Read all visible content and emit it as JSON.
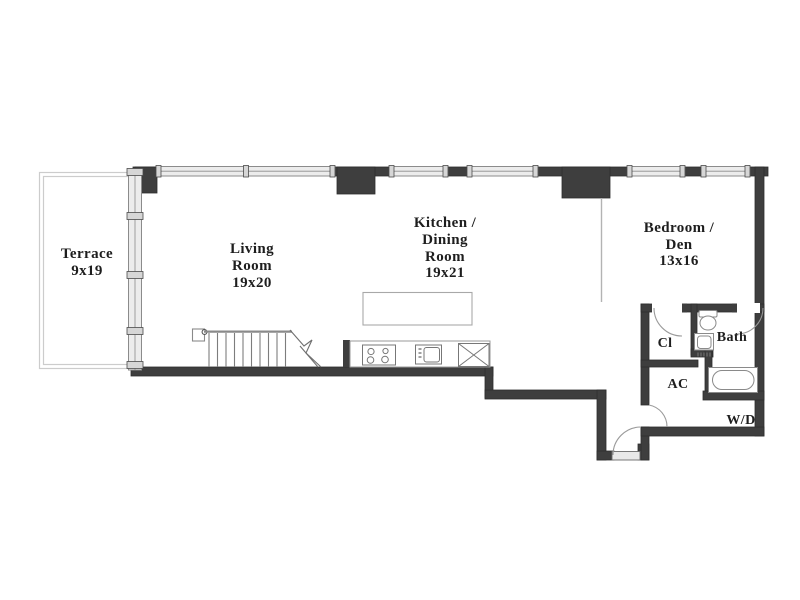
{
  "colors": {
    "wall": "#3e3e3e",
    "window_fill": "#ececec",
    "window_stroke": "#8b8b8b",
    "window_cap": "#d6d6d6",
    "fixture_stroke": "#8a8a8a",
    "terrace_outline": "#cccccc",
    "text": "#1e1e1e",
    "background": "#ffffff"
  },
  "rooms": {
    "terrace": {
      "name": "Terrace",
      "dims": "9x19"
    },
    "living_room": {
      "line1": "Living",
      "line2": "Room",
      "dims": "19x20"
    },
    "kitchen_dining": {
      "line1": "Kitchen /",
      "line2": "Dining",
      "line3": "Room",
      "dims": "19x21"
    },
    "bedroom_den": {
      "line1": "Bedroom /",
      "line2": "Den",
      "dims": "13x16"
    },
    "closet": {
      "name": "Cl"
    },
    "bath": {
      "name": "Bath"
    },
    "ac": {
      "name": "AC"
    },
    "washer_dryer": {
      "name": "W/D"
    }
  },
  "icons": {
    "staircase": "staircase-with-break-line",
    "kitchen_island": "kitchen-island",
    "range": "range-4-burner-icon",
    "kitchen_sink": "kitchen-sink-icon",
    "x_appliance": "appliance-x-box-icon",
    "toilet": "toilet-icon",
    "bath_sink": "bathroom-sink-icon",
    "bathtub": "bathtub-icon",
    "door_swing": "door-swing-arc-icon",
    "window": "window-segment-icon"
  }
}
